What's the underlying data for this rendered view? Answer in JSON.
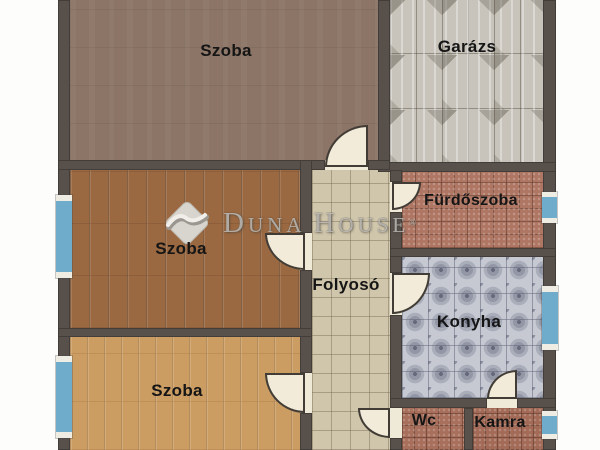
{
  "rooms": {
    "szoba_top": {
      "label": "Szoba"
    },
    "garazs": {
      "label": "Garázs"
    },
    "szoba_mid": {
      "label": "Szoba"
    },
    "furdoszoba": {
      "label": "Fürdőszoba"
    },
    "folyoso": {
      "label": "Folyosó"
    },
    "konyha": {
      "label": "Konyha"
    },
    "szoba_bottom": {
      "label": "Szoba"
    },
    "wc": {
      "label": "Wc"
    },
    "kamra": {
      "label": "Kamra"
    }
  },
  "watermark": {
    "word1": "Duna",
    "word2": "House",
    "registered": "®"
  },
  "palette": {
    "wall": "#57504b",
    "window_glass": "#6fabcb",
    "window_frame": "#efede3",
    "door_leaf": "#f2ebd9",
    "label_text": "#151515",
    "floor_szoba_top": "#8c7566",
    "floor_szoba_mid": "#9b6941",
    "floor_szoba_bottom": "#cb9d62",
    "floor_garazs": "#c8c4bb",
    "floor_folyoso": "#d0c6ac",
    "floor_furdoszoba": "#ae7663",
    "floor_konyha": "#c6c9d2",
    "floor_wc": "#a76f5c",
    "floor_kamra": "#a36b57"
  }
}
